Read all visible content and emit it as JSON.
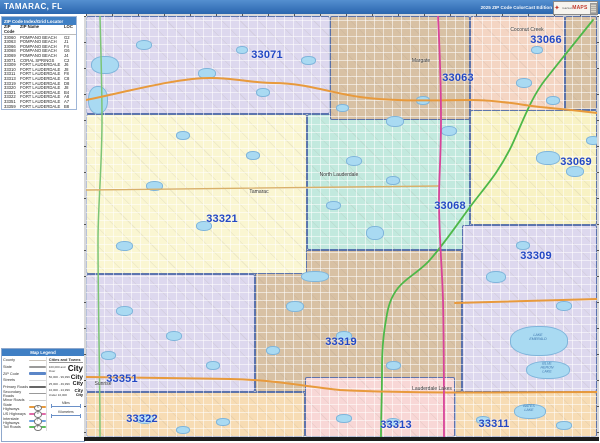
{
  "header": {
    "title": "TAMARAC, FL",
    "edition": "2025 ZIP Code ColorCast Edition",
    "logo_market": "market",
    "logo_maps": "MAPS"
  },
  "index_table": {
    "title": "ZIP Code Index/Grid Locator",
    "columns": [
      "ZIP Code",
      "ZIP Name",
      "LOC"
    ],
    "rows": [
      {
        "zip": "33060",
        "name": "POMPANO BEACH",
        "loc": "G2"
      },
      {
        "zip": "33063",
        "name": "POMPANO BEACH",
        "loc": "J1"
      },
      {
        "zip": "33066",
        "name": "POMPANO BEACH",
        "loc": "F4"
      },
      {
        "zip": "33068",
        "name": "POMPANO BEACH",
        "loc": "G6"
      },
      {
        "zip": "33069",
        "name": "POMPANO BEACH",
        "loc": "J4"
      },
      {
        "zip": "33071",
        "name": "CORAL SPRINGS",
        "loc": "C2"
      },
      {
        "zip": "33309",
        "name": "FORT LAUDERDALE",
        "loc": "J6"
      },
      {
        "zip": "33310",
        "name": "FORT LAUDERDALE",
        "loc": "J8"
      },
      {
        "zip": "33311",
        "name": "FORT LAUDERDALE",
        "loc": "F8"
      },
      {
        "zip": "33313",
        "name": "FORT LAUDERDALE",
        "loc": "C8"
      },
      {
        "zip": "33319",
        "name": "FORT LAUDERDALE",
        "loc": "D8"
      },
      {
        "zip": "33320",
        "name": "FORT LAUDERDALE",
        "loc": "J8"
      },
      {
        "zip": "33321",
        "name": "FORT LAUDERDALE",
        "loc": "B4"
      },
      {
        "zip": "33322",
        "name": "FORT LAUDERDALE",
        "loc": "A8"
      },
      {
        "zip": "33351",
        "name": "FORT LAUDERDALE",
        "loc": "A7"
      },
      {
        "zip": "33359",
        "name": "FORT LAUDERDALE",
        "loc": "B8"
      }
    ]
  },
  "legend": {
    "title": "Map Legend",
    "line_items": [
      {
        "label": "County",
        "color": "#c9c2b8",
        "w": 1.5
      },
      {
        "label": "State",
        "color": "#9a9a9a",
        "w": 2
      },
      {
        "label": "ZIP Code",
        "color": "#5b86c8",
        "w": 2.5
      },
      {
        "label": "Streets",
        "color": "#d8d8d8",
        "w": 1
      },
      {
        "label": "Primary Roads",
        "color": "#666666",
        "w": 1.5
      },
      {
        "label": "Secondary Roads",
        "color": "#999999",
        "w": 1
      },
      {
        "label": "Minor Roads",
        "color": "#cccccc",
        "w": 1
      },
      {
        "label": "State Highways",
        "color": "#e89a3c",
        "w": 2,
        "shield": "S"
      },
      {
        "label": "US Highways",
        "color": "#e06aa8",
        "w": 2,
        "shield": "U"
      },
      {
        "label": "Interstate Highways",
        "color": "#6aa2e0",
        "w": 2,
        "shield": "I"
      },
      {
        "label": "Toll Roads",
        "color": "#5cbf5c",
        "w": 2,
        "shield": "T"
      }
    ],
    "cities_header": "Cities and Towns",
    "city_sample": "City",
    "city_sizes": [
      {
        "range": "100,000 and Over",
        "px": 8
      },
      {
        "range": "50,000 - 99,999",
        "px": 6.5
      },
      {
        "range": "25,000 - 49,999",
        "px": 5.5
      },
      {
        "range": "10,000 - 24,999",
        "px": 4.5
      },
      {
        "range": "Under 10,000",
        "px": 3.8
      }
    ],
    "scales": [
      {
        "label": "Miles"
      },
      {
        "label": "Kilometers"
      }
    ]
  },
  "map": {
    "colors": {
      "lavender": "#ddd8ee",
      "tan": "#d8c1a4",
      "salmon": "#f4d5c3",
      "mint": "#c2e9de",
      "yellow": "#faf6d2",
      "yellow2": "#f8f2c4",
      "peach": "#f7dcb4",
      "pink": "#f8d7d6",
      "water": "#a9daf2",
      "boundary": "#4c68a8",
      "zip_label": "#2348c4",
      "state_hwy": "#e89a3c",
      "us_hwy": "#d8439a",
      "toll": "#4db848",
      "toll2": "#7cc576",
      "major": "#d9b06a"
    },
    "regions": [
      {
        "zip": "33319",
        "x": 169,
        "y": 234,
        "w": 207,
        "h": 142,
        "color": "#d8c1a4"
      },
      {
        "zip": "33321",
        "x": 0,
        "y": 98,
        "w": 221,
        "h": 160,
        "color": "#faf6d2"
      },
      {
        "zip": "33351",
        "x": 0,
        "y": 258,
        "w": 169,
        "h": 118,
        "color": "#ddd8ee"
      },
      {
        "zip": "33071",
        "x": 0,
        "y": 0,
        "w": 244,
        "h": 98,
        "color": "#ddd8ee"
      },
      {
        "zip": "33068",
        "x": 221,
        "y": 98,
        "w": 163,
        "h": 136,
        "color": "#c2e9de"
      },
      {
        "zip": "33063",
        "x": 244,
        "y": 0,
        "w": 140,
        "h": 104,
        "color": "#d8c1a4"
      },
      {
        "zip": "33066",
        "x": 384,
        "y": 0,
        "w": 95,
        "h": 104,
        "color": "#f4d5c3"
      },
      {
        "zip": "ne-corner",
        "x": 479,
        "y": 0,
        "w": 32,
        "h": 94,
        "color": "#d8c1a4"
      },
      {
        "zip": "33069",
        "x": 384,
        "y": 94,
        "w": 127,
        "h": 115,
        "color": "#f8f2c4"
      },
      {
        "zip": "33309",
        "x": 376,
        "y": 209,
        "w": 135,
        "h": 167,
        "color": "#ddd8ee"
      },
      {
        "zip": "33322",
        "x": 0,
        "y": 376,
        "w": 219,
        "h": 45,
        "color": "#f7dcb4"
      },
      {
        "zip": "33313",
        "x": 219,
        "y": 361,
        "w": 150,
        "h": 60,
        "color": "#f8d7d6"
      },
      {
        "zip": "33311",
        "x": 369,
        "y": 376,
        "w": 142,
        "h": 45,
        "color": "#f7dcb4"
      }
    ],
    "roads": [
      {
        "name": "toll-road-turnpike",
        "color": "#4db848",
        "w": 1.8,
        "d": "M507,4 C490,25 475,44 459,64 C445,82 437,105 426,129 C412,158 398,172 384,191 C370,210 355,232 342,246 C330,258 320,262 312,272 C305,281 302,290 300,304 C297,320 296,335 296,354 C296,380 295,400 295,421"
      },
      {
        "name": "toll-road-west",
        "color": "#7cc576",
        "w": 1.5,
        "d": "M14,0 C15,40 16,70 16,104 C16,150 12,190 12,224 C12,290 14,360 14,421"
      },
      {
        "name": "state-highway-north",
        "color": "#e89a3c",
        "w": 2,
        "d": "M0,84 C40,76 90,62 124,62 C150,62 165,67 187,67 C220,67 245,77 274,81 C310,86 350,84 384,84 C410,84 430,88 454,91 C475,93 495,95 511,97"
      },
      {
        "name": "state-highway-commercial",
        "color": "#d9b06a",
        "w": 1.4,
        "d": "M0,174 L352,170"
      },
      {
        "name": "state-highway-east",
        "color": "#e89a3c",
        "w": 2,
        "d": "M369,287 L511,283"
      },
      {
        "name": "state-highway-oakland",
        "color": "#e89a3c",
        "w": 2,
        "d": "M0,361 C60,362 100,362 144,363 C190,364 215,370 254,374 C330,378 430,376 511,376"
      },
      {
        "name": "us-highway-441",
        "color": "#d8439a",
        "w": 1.8,
        "d": "M352,0 C354,40 355,70 355,104 C355,140 353,160 353,184 C353,220 356,250 357,284 C358,330 358,380 358,421"
      }
    ],
    "waters": [
      {
        "x": 5,
        "y": 40,
        "w": 26,
        "h": 16
      },
      {
        "x": 2,
        "y": 70,
        "w": 18,
        "h": 26
      },
      {
        "x": 50,
        "y": 24,
        "w": 14,
        "h": 8
      },
      {
        "x": 112,
        "y": 52,
        "w": 16,
        "h": 9
      },
      {
        "x": 170,
        "y": 72,
        "w": 12,
        "h": 7
      },
      {
        "x": 215,
        "y": 40,
        "w": 13,
        "h": 7
      },
      {
        "x": 250,
        "y": 88,
        "w": 11,
        "h": 6
      },
      {
        "x": 150,
        "y": 30,
        "w": 10,
        "h": 6
      },
      {
        "x": 300,
        "y": 100,
        "w": 16,
        "h": 9
      },
      {
        "x": 330,
        "y": 80,
        "w": 12,
        "h": 7
      },
      {
        "x": 355,
        "y": 110,
        "w": 14,
        "h": 8
      },
      {
        "x": 430,
        "y": 62,
        "w": 14,
        "h": 8
      },
      {
        "x": 460,
        "y": 80,
        "w": 12,
        "h": 7
      },
      {
        "x": 445,
        "y": 30,
        "w": 10,
        "h": 6
      },
      {
        "x": 450,
        "y": 135,
        "w": 22,
        "h": 12
      },
      {
        "x": 480,
        "y": 150,
        "w": 16,
        "h": 9
      },
      {
        "x": 500,
        "y": 120,
        "w": 12,
        "h": 7
      },
      {
        "x": 260,
        "y": 140,
        "w": 14,
        "h": 8
      },
      {
        "x": 240,
        "y": 185,
        "w": 13,
        "h": 7
      },
      {
        "x": 300,
        "y": 160,
        "w": 12,
        "h": 7
      },
      {
        "x": 280,
        "y": 210,
        "w": 16,
        "h": 12
      },
      {
        "x": 60,
        "y": 165,
        "w": 15,
        "h": 8
      },
      {
        "x": 110,
        "y": 205,
        "w": 14,
        "h": 8
      },
      {
        "x": 160,
        "y": 135,
        "w": 12,
        "h": 7
      },
      {
        "x": 30,
        "y": 225,
        "w": 15,
        "h": 8
      },
      {
        "x": 90,
        "y": 115,
        "w": 12,
        "h": 7
      },
      {
        "x": 30,
        "y": 290,
        "w": 15,
        "h": 8
      },
      {
        "x": 80,
        "y": 315,
        "w": 14,
        "h": 8
      },
      {
        "x": 120,
        "y": 345,
        "w": 12,
        "h": 7
      },
      {
        "x": 15,
        "y": 335,
        "w": 13,
        "h": 7
      },
      {
        "x": 200,
        "y": 285,
        "w": 16,
        "h": 9
      },
      {
        "x": 250,
        "y": 315,
        "w": 14,
        "h": 8
      },
      {
        "x": 300,
        "y": 345,
        "w": 13,
        "h": 7
      },
      {
        "x": 215,
        "y": 255,
        "w": 26,
        "h": 9
      },
      {
        "x": 180,
        "y": 330,
        "w": 12,
        "h": 7
      },
      {
        "x": 400,
        "y": 255,
        "w": 18,
        "h": 10
      },
      {
        "x": 470,
        "y": 285,
        "w": 14,
        "h": 8
      },
      {
        "x": 430,
        "y": 225,
        "w": 12,
        "h": 7
      },
      {
        "x": 424,
        "y": 310,
        "w": 56,
        "h": 28,
        "name": "lake-emerald"
      },
      {
        "x": 440,
        "y": 345,
        "w": 42,
        "h": 16,
        "name": "blue-heron-lake"
      },
      {
        "x": 428,
        "y": 388,
        "w": 30,
        "h": 13,
        "name": "bates-lake"
      },
      {
        "x": 250,
        "y": 398,
        "w": 14,
        "h": 7
      },
      {
        "x": 300,
        "y": 402,
        "w": 12,
        "h": 6
      },
      {
        "x": 50,
        "y": 398,
        "w": 16,
        "h": 8
      },
      {
        "x": 130,
        "y": 402,
        "w": 12,
        "h": 6
      },
      {
        "x": 90,
        "y": 410,
        "w": 12,
        "h": 6
      },
      {
        "x": 470,
        "y": 405,
        "w": 14,
        "h": 7
      },
      {
        "x": 390,
        "y": 400,
        "w": 12,
        "h": 6
      }
    ],
    "zip_labels": [
      {
        "zip": "33071",
        "x": 181,
        "y": 39
      },
      {
        "zip": "33063",
        "x": 372,
        "y": 62
      },
      {
        "zip": "33066",
        "x": 460,
        "y": 24
      },
      {
        "zip": "33069",
        "x": 490,
        "y": 146
      },
      {
        "zip": "33068",
        "x": 364,
        "y": 190
      },
      {
        "zip": "33321",
        "x": 136,
        "y": 203
      },
      {
        "zip": "33309",
        "x": 450,
        "y": 240
      },
      {
        "zip": "33319",
        "x": 255,
        "y": 326
      },
      {
        "zip": "33351",
        "x": 36,
        "y": 363
      },
      {
        "zip": "33322",
        "x": 56,
        "y": 403
      },
      {
        "zip": "33313",
        "x": 310,
        "y": 409
      },
      {
        "zip": "33311",
        "x": 408,
        "y": 408
      }
    ],
    "city_labels": [
      {
        "name": "Margate",
        "x": 335,
        "y": 45
      },
      {
        "name": "Coconut Creek",
        "x": 441,
        "y": 14
      },
      {
        "name": "Tamarac",
        "x": 173,
        "y": 176
      },
      {
        "name": "North Lauderdale",
        "x": 253,
        "y": 159
      },
      {
        "name": "Sunrise",
        "x": 17,
        "y": 368
      },
      {
        "name": "Lauderdale Lakes",
        "x": 346,
        "y": 373
      }
    ],
    "lake_labels": [
      {
        "name": "LAKE\nEMERALD",
        "x": 452,
        "y": 322
      },
      {
        "name": "BLUE\nHERON\nLAKE",
        "x": 461,
        "y": 352
      },
      {
        "name": "BATES\nLAKE",
        "x": 443,
        "y": 393
      }
    ]
  }
}
